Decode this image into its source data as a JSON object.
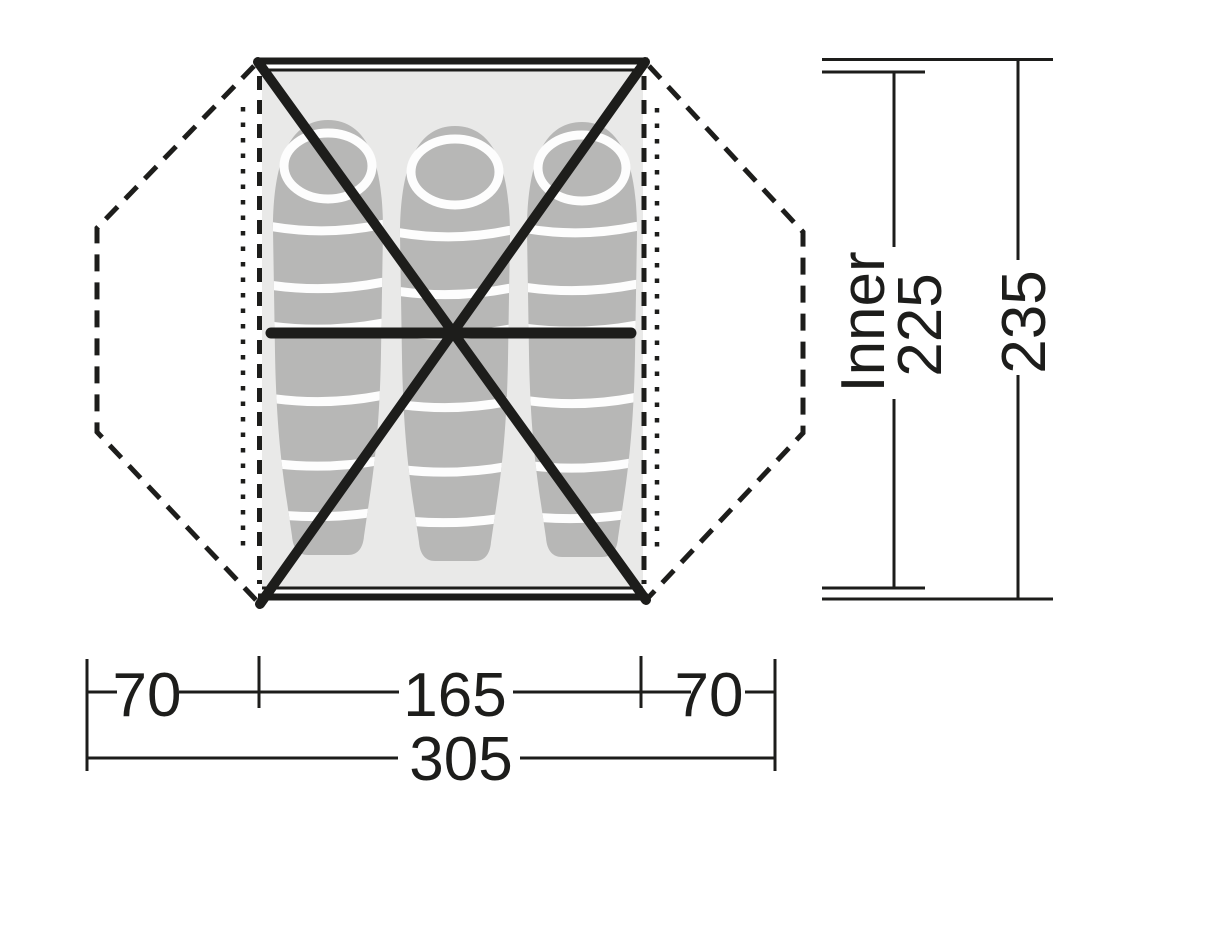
{
  "diagram": {
    "type": "tent-floorplan-dimension-drawing",
    "sleeping_bag_count": 3,
    "colors": {
      "line": "#1d1d1b",
      "floor": "#e9e9e8",
      "bag": "#b7b7b6",
      "stripe": "#fdfdfd",
      "bg": "#ffffff"
    },
    "dimensions_bottom": {
      "left_vestibule": "70",
      "inner_width": "165",
      "right_vestibule": "70",
      "total_width": "305"
    },
    "dimensions_right": {
      "inner_label": "Inner",
      "inner_length": "225",
      "total_length": "235"
    }
  }
}
